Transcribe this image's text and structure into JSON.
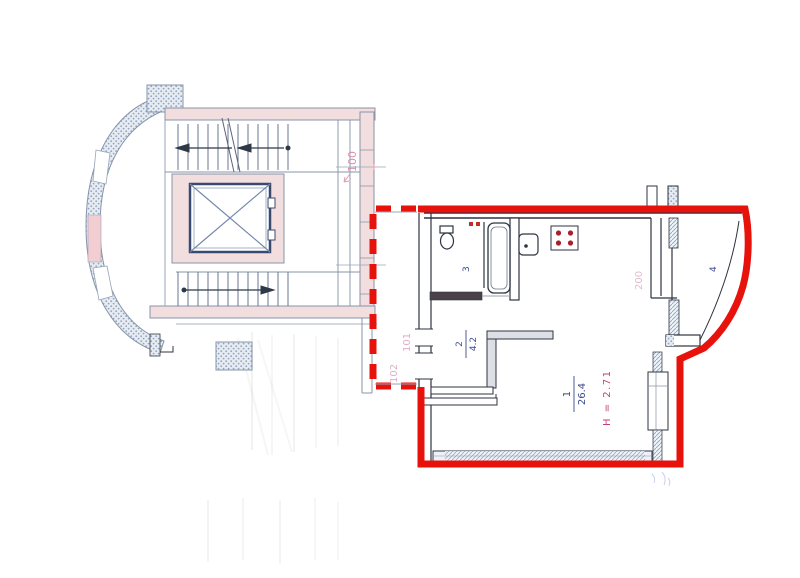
{
  "colors": {
    "outline_red": "#e8120c",
    "unit_label_pink": "#d687a6",
    "unit_label_pink_faded": "#d9a2ba",
    "room_label_blue": "#3a4a8e",
    "height_label_magenta": "#c2417c",
    "dim_label_pink": "#d9a4bc"
  },
  "labels": {
    "unit_100": "100",
    "unit_101": "101",
    "unit_102": "102"
  },
  "rooms": {
    "living": {
      "number": "1",
      "area": "26.4",
      "height": "H = 2.71"
    },
    "hall": {
      "number": "2",
      "area": "4.2"
    },
    "bathroom": {
      "number": "3"
    },
    "balcony": {
      "number": "4"
    }
  },
  "dimensions": {
    "wall_200": "200"
  }
}
